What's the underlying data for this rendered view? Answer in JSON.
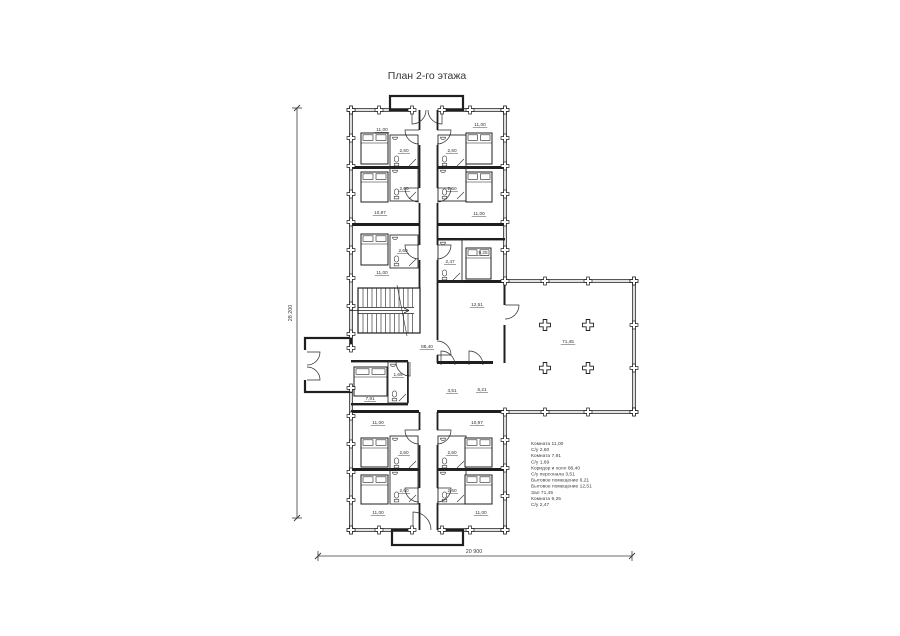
{
  "title": "План 2-го этажа",
  "dimensions": {
    "vertical": "28 200",
    "horizontal": "20 900"
  },
  "legend": {
    "lines": [
      "Комната 11,00",
      "С/у 2,60",
      "Комната 7,91",
      "С/у 1,69",
      "Коридор и холл 88,40",
      "С/у персонала 3,51",
      "Бытовое помещение 6,21",
      "Бытовое помещение 12,51",
      "Зал 71,45",
      "Комната 9,25",
      "С/у 2,47"
    ]
  },
  "plan": {
    "room_labels": [
      {
        "name": "room-top-left-1",
        "value": "11,00",
        "x": 382,
        "y": 131
      },
      {
        "name": "bath-top-left-1",
        "value": "2,60",
        "x": 404,
        "y": 152
      },
      {
        "name": "room-top-right-1",
        "value": "11,00",
        "x": 480,
        "y": 126
      },
      {
        "name": "bath-top-right-1",
        "value": "2,60",
        "x": 452,
        "y": 152
      },
      {
        "name": "room-top-left-2",
        "value": "10,97",
        "x": 380,
        "y": 214
      },
      {
        "name": "bath-top-left-2",
        "value": "2,60",
        "x": 404,
        "y": 190
      },
      {
        "name": "room-top-right-2",
        "value": "11,00",
        "x": 479,
        "y": 215
      },
      {
        "name": "bath-top-right-2",
        "value": "2,60",
        "x": 452,
        "y": 190
      },
      {
        "name": "room-top-left-3",
        "value": "11,00",
        "x": 382,
        "y": 274
      },
      {
        "name": "bath-top-left-3",
        "value": "2,60",
        "x": 403,
        "y": 252
      },
      {
        "name": "room-staff",
        "value": "9,25",
        "x": 483,
        "y": 254
      },
      {
        "name": "bath-staff",
        "value": "2,47",
        "x": 450,
        "y": 263
      },
      {
        "name": "room-utility-12",
        "value": "12,51",
        "x": 477,
        "y": 306
      },
      {
        "name": "corridor-hall",
        "value": "88,40",
        "x": 427,
        "y": 348
      },
      {
        "name": "hall",
        "value": "71,45",
        "x": 568,
        "y": 343
      },
      {
        "name": "room-lower-left",
        "value": "7,91",
        "x": 370,
        "y": 400
      },
      {
        "name": "bath-lower-left",
        "value": "1,69",
        "x": 398,
        "y": 376
      },
      {
        "name": "staff-wc",
        "value": "3,51",
        "x": 452,
        "y": 392
      },
      {
        "name": "room-utility-6",
        "value": "6,21",
        "x": 482,
        "y": 391
      },
      {
        "name": "room-bottom-left-1",
        "value": "11,00",
        "x": 378,
        "y": 424
      },
      {
        "name": "bath-bottom-left-1",
        "value": "2,60",
        "x": 404,
        "y": 454
      },
      {
        "name": "room-bottom-right-1",
        "value": "10,97",
        "x": 477,
        "y": 424
      },
      {
        "name": "bath-bottom-right-1",
        "value": "2,60",
        "x": 452,
        "y": 454
      },
      {
        "name": "room-bottom-left-2",
        "value": "11,00",
        "x": 378,
        "y": 514
      },
      {
        "name": "bath-bottom-left-2",
        "value": "2,60",
        "x": 404,
        "y": 492
      },
      {
        "name": "room-bottom-right-2",
        "value": "11,00",
        "x": 481,
        "y": 514
      },
      {
        "name": "bath-bottom-right-2",
        "value": "2,60",
        "x": 452,
        "y": 492
      }
    ]
  }
}
